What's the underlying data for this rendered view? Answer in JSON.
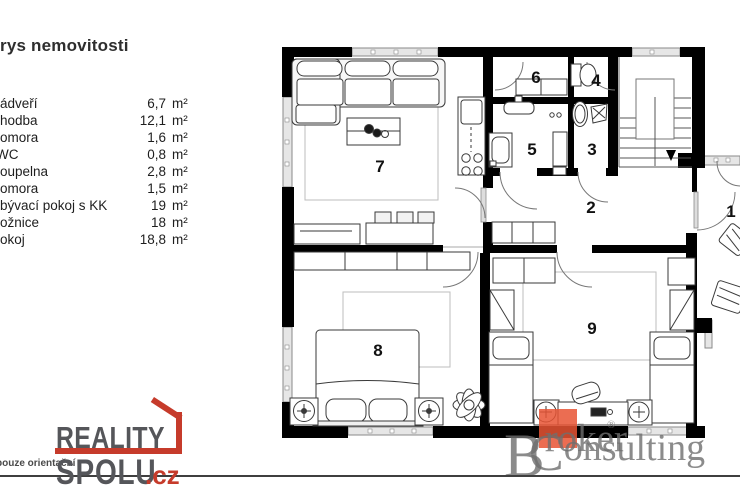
{
  "header": {
    "title": "rys nemovitosti"
  },
  "legend": {
    "unit": "m²",
    "items": [
      {
        "name": "ádveří",
        "area": "6,7"
      },
      {
        "name": "hodba",
        "area": "12,1"
      },
      {
        "name": "omora",
        "area": "1,6"
      },
      {
        "name": "WC",
        "area": "0,8"
      },
      {
        "name": "oupelna",
        "area": "2,8"
      },
      {
        "name": "omora",
        "area": "1,5"
      },
      {
        "name": "bývací pokoj s KK",
        "area": "19"
      },
      {
        "name": "ožnice",
        "area": "18"
      },
      {
        "name": "okoj",
        "area": "18,8"
      }
    ]
  },
  "plan": {
    "room_numbers": [
      "1",
      "2",
      "3",
      "4",
      "5",
      "6",
      "7",
      "8",
      "9"
    ],
    "wall_color": "#000000"
  },
  "footer": {
    "disclaimer": "pouze orientační"
  },
  "logos": {
    "reality_spolu": {
      "line1": "REALITY",
      "line2": "SPOLU",
      "tld": ".cz",
      "accent_color": "#c63b2b",
      "text_color": "#55565a"
    },
    "broker_consulting": {
      "word1_initial": "B",
      "word1_rest": "roker",
      "registered": "®",
      "word2_initial": "C",
      "word2_rest": "onsulting",
      "square_color": "#e85434",
      "text_color": "#6f6f6f"
    }
  }
}
